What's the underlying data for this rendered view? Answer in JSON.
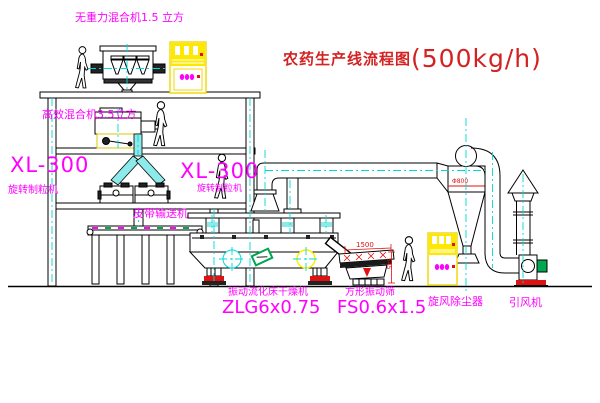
{
  "title": {
    "name": "农药生产线流程图",
    "capacity": "(500kg/h)"
  },
  "labels": {
    "top_mixer": "无重力混合机1.5 立方",
    "floor2_mixer": "高效混合机3.5立方",
    "xl_left_model": "XL-300",
    "xl_left_name": "旋转制粒机",
    "xl_right_model": "XL-300",
    "xl_right_name": "旋转制粒机",
    "belt": "皮带输送机",
    "dryer_name": "振动流化床干燥机",
    "dryer_model": "ZLG6x0.75",
    "sieve_name": "方形振动筛",
    "sieve_model": "FS0.6x1.5",
    "cyclone": "旋风除尘器",
    "fan": "引风机"
  },
  "dims": {
    "sieve_w": "1500",
    "cyclone_d": "Φ800",
    "sieve_h": "545"
  },
  "colors": {
    "line": "#000000",
    "label": "#ff00ff",
    "title": "#d42222",
    "centerline": "#00d8d8",
    "cabinet": "#ffe800",
    "alert": "#e01111",
    "machine_green": "#00a650"
  }
}
